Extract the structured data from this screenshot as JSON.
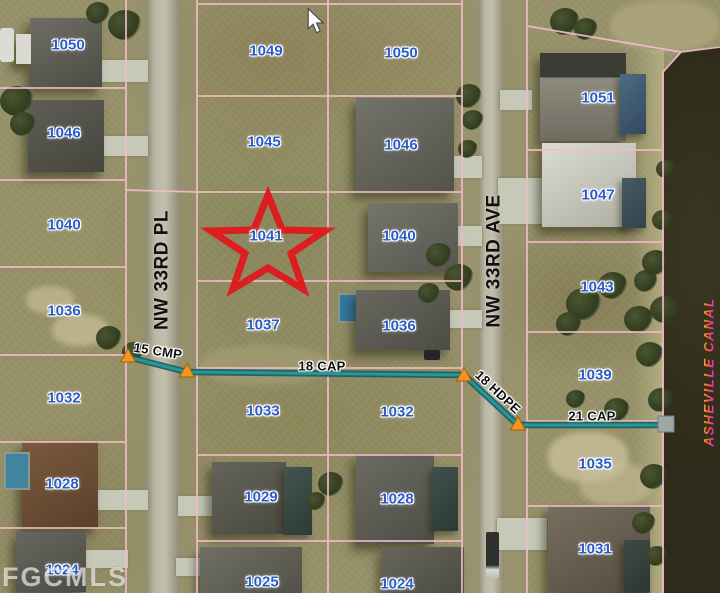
{
  "watermark": "FGCMLS",
  "marked_lot": "1041",
  "cursor": {
    "x": 306,
    "y": 8
  },
  "streets": [
    {
      "id": "nw-33rd-pl",
      "name": "NW 33RD PL",
      "x": 162,
      "y": 270
    },
    {
      "id": "nw-33rd-ave",
      "name": "NW 33RD AVE",
      "x": 494,
      "y": 261
    }
  ],
  "canal_label": {
    "name": "ASHEVILLE CANAL",
    "x": 709,
    "y": 372
  },
  "lot_labels": [
    {
      "n": "1050",
      "x": 68,
      "y": 45
    },
    {
      "n": "1046",
      "x": 64,
      "y": 133
    },
    {
      "n": "1040",
      "x": 64,
      "y": 225
    },
    {
      "n": "1036",
      "x": 64,
      "y": 311
    },
    {
      "n": "1032",
      "x": 64,
      "y": 398
    },
    {
      "n": "1028",
      "x": 62,
      "y": 484
    },
    {
      "n": "1024",
      "x": 62,
      "y": 570
    },
    {
      "n": "1049",
      "x": 266,
      "y": 51
    },
    {
      "n": "1045",
      "x": 264,
      "y": 142
    },
    {
      "n": "1041",
      "x": 266,
      "y": 236
    },
    {
      "n": "1037",
      "x": 263,
      "y": 325
    },
    {
      "n": "1033",
      "x": 263,
      "y": 411
    },
    {
      "n": "1029",
      "x": 261,
      "y": 497
    },
    {
      "n": "1025",
      "x": 262,
      "y": 582
    },
    {
      "n": "1050",
      "x": 401,
      "y": 53
    },
    {
      "n": "1046",
      "x": 401,
      "y": 145
    },
    {
      "n": "1040",
      "x": 399,
      "y": 236
    },
    {
      "n": "1036",
      "x": 399,
      "y": 326
    },
    {
      "n": "1032",
      "x": 397,
      "y": 412
    },
    {
      "n": "1028",
      "x": 397,
      "y": 499
    },
    {
      "n": "1024",
      "x": 397,
      "y": 584
    },
    {
      "n": "1051",
      "x": 598,
      "y": 98
    },
    {
      "n": "1047",
      "x": 598,
      "y": 195
    },
    {
      "n": "1043",
      "x": 597,
      "y": 287
    },
    {
      "n": "1039",
      "x": 595,
      "y": 375
    },
    {
      "n": "1035",
      "x": 595,
      "y": 464
    },
    {
      "n": "1031",
      "x": 595,
      "y": 549
    }
  ],
  "utility_labels": [
    {
      "text": "15 CMP",
      "x": 158,
      "y": 351,
      "rot": 9
    },
    {
      "text": "18 CAP",
      "x": 322,
      "y": 366,
      "rot": 0
    },
    {
      "text": "18 HDPE",
      "x": 498,
      "y": 392,
      "rot": 43
    },
    {
      "text": "21 CAP",
      "x": 592,
      "y": 416,
      "rot": 0
    }
  ],
  "colors": {
    "parcel_line": "#F3BCCA",
    "lot_number_text": "#2B5CC8",
    "street_text": "#101010",
    "utility_line": "#2C9396",
    "utility_marker": "#F5941F",
    "subject_star": "#E2181E",
    "water": "#2E2B1A",
    "canal_label_orange": "#FFB03A",
    "canal_label_magenta": "#EA2CC0",
    "watermark_white": "#FFFFFF"
  }
}
